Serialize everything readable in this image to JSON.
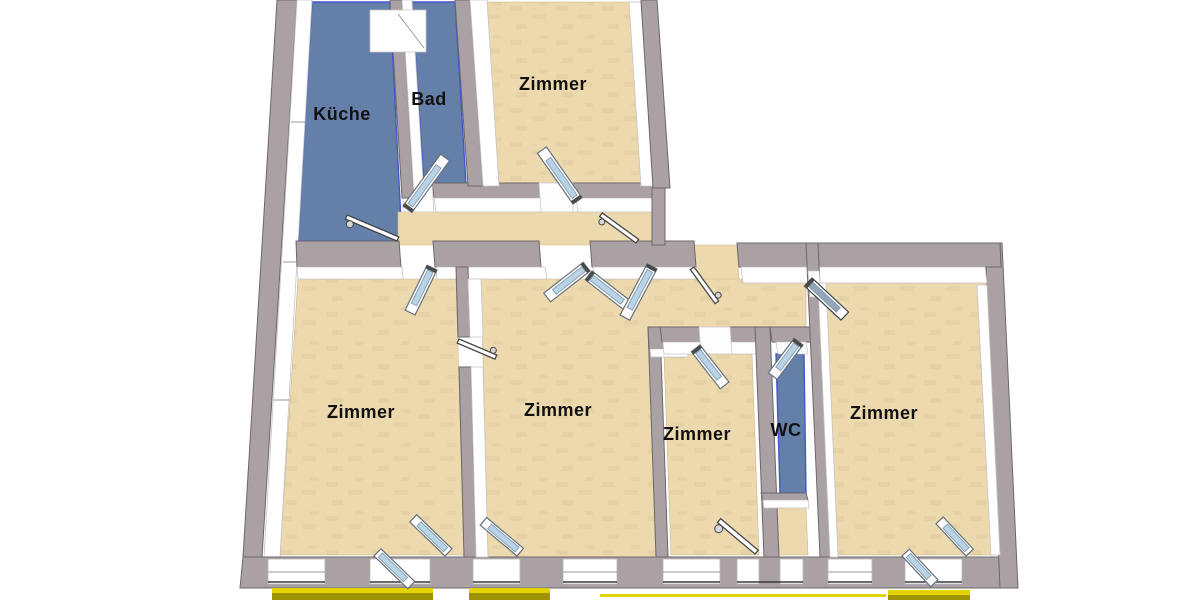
{
  "plan": {
    "rooms": [
      {
        "id": "kueche",
        "label": "Küche",
        "floor": "wet"
      },
      {
        "id": "bad",
        "label": "Bad",
        "floor": "wet"
      },
      {
        "id": "zimmer-top",
        "label": "Zimmer",
        "floor": "wood"
      },
      {
        "id": "zimmer-left",
        "label": "Zimmer",
        "floor": "wood"
      },
      {
        "id": "zimmer-middle",
        "label": "Zimmer",
        "floor": "wood"
      },
      {
        "id": "zimmer-small",
        "label": "Zimmer",
        "floor": "wood"
      },
      {
        "id": "wc",
        "label": "WC",
        "floor": "wet"
      },
      {
        "id": "zimmer-right",
        "label": "Zimmer",
        "floor": "wood"
      }
    ],
    "colors": {
      "background": "#ffffff",
      "wall": "#a9a1a3",
      "wall_outline": "#6e6769",
      "wall_face": "#ffffff",
      "floor_wood": "#ecd9ae",
      "floor_wet": "#6580a8",
      "wet_edge": "#4456cc",
      "glass": "#b9d3e6",
      "glass_dark": "#93a7b8",
      "balcony_bright": "#e3d300",
      "balcony_dark": "#9d9400",
      "label_text": "#111111"
    }
  }
}
